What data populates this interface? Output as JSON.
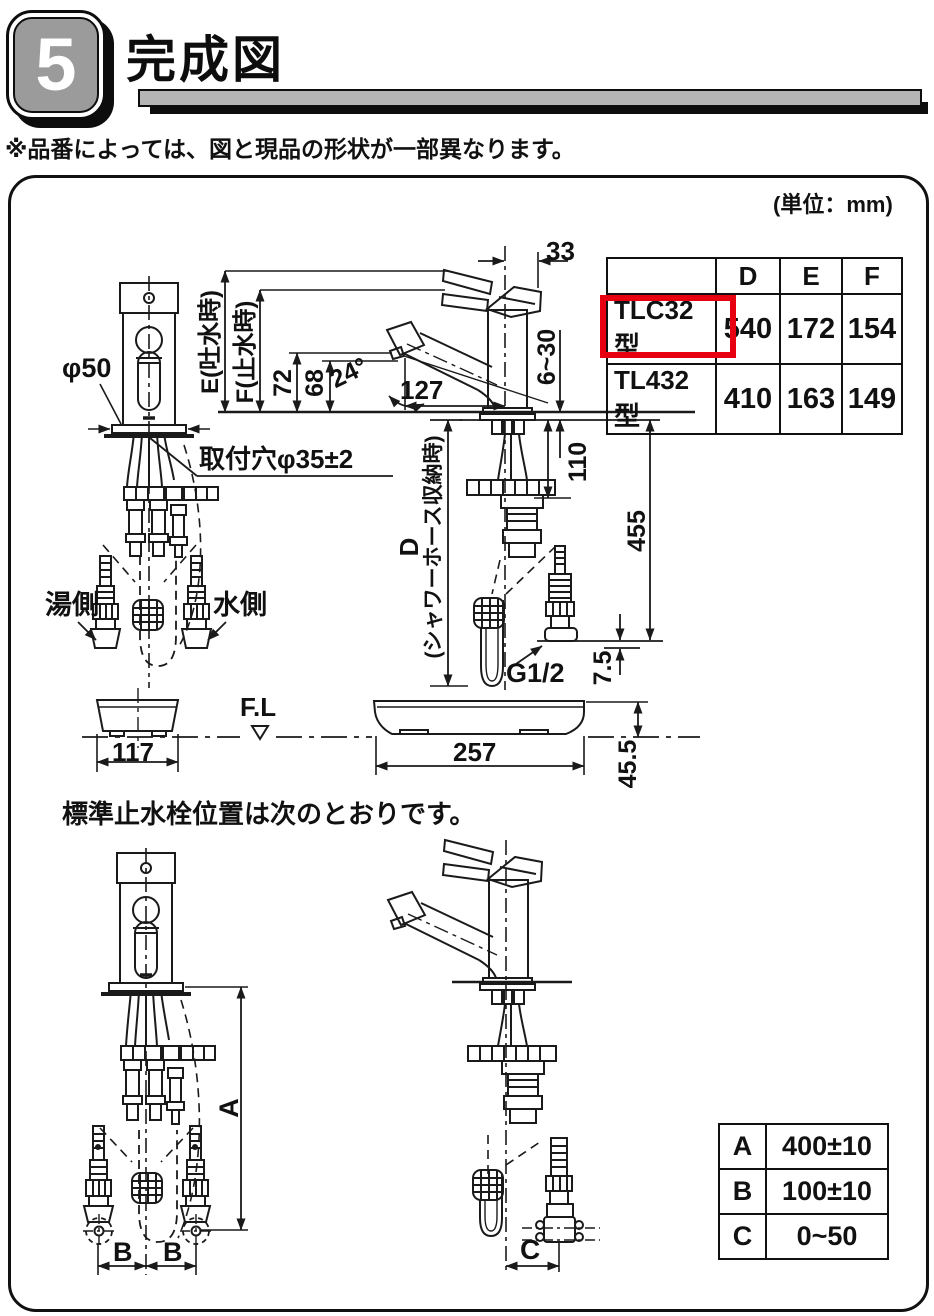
{
  "header": {
    "section_number": "5",
    "title": "完成図"
  },
  "note": "※品番によっては、図と現品の形状が一部異なります。",
  "panel": {
    "unit_label": "(単位：mm)"
  },
  "model_table": {
    "col_headers": [
      "D",
      "E",
      "F"
    ],
    "rows": [
      {
        "model": "TLC32型",
        "values": [
          "540",
          "172",
          "154"
        ],
        "highlighted": true
      },
      {
        "model": "TL432型",
        "values": [
          "410",
          "163",
          "149"
        ],
        "highlighted": false
      }
    ],
    "highlight_color": "#e60012"
  },
  "upper_diagram": {
    "front_view": {
      "diameter": "φ50",
      "mount_hole": "取付穴φ35±2",
      "hot_side": "湯側",
      "cold_side": "水側",
      "base_width": "117"
    },
    "side_view": {
      "lever_offset": "33",
      "e_label": "E(吐水時)",
      "f_label": "F(止水時)",
      "spout_height_72": "72",
      "spout_height_68": "68",
      "spout_angle": "24°",
      "spout_reach": "127",
      "deck_thickness": "6~30",
      "dim_110": "110",
      "dim_455": "455",
      "d_label": "D",
      "d_note": "(シャワーホース収納時)",
      "thread": "G1/2",
      "dim_7_5": "7.5",
      "base_width": "257",
      "base_height": "45.5"
    },
    "floor_line": "F.L"
  },
  "lower_section": {
    "heading": "標準止水栓位置は次のとおりです。",
    "dim_a": "A",
    "dim_b_left": "B",
    "dim_b_right": "B",
    "dim_c": "C",
    "position_table": {
      "rows": [
        {
          "key": "A",
          "value": "400±10"
        },
        {
          "key": "B",
          "value": "100±10"
        },
        {
          "key": "C",
          "value": "0~50"
        }
      ]
    }
  }
}
